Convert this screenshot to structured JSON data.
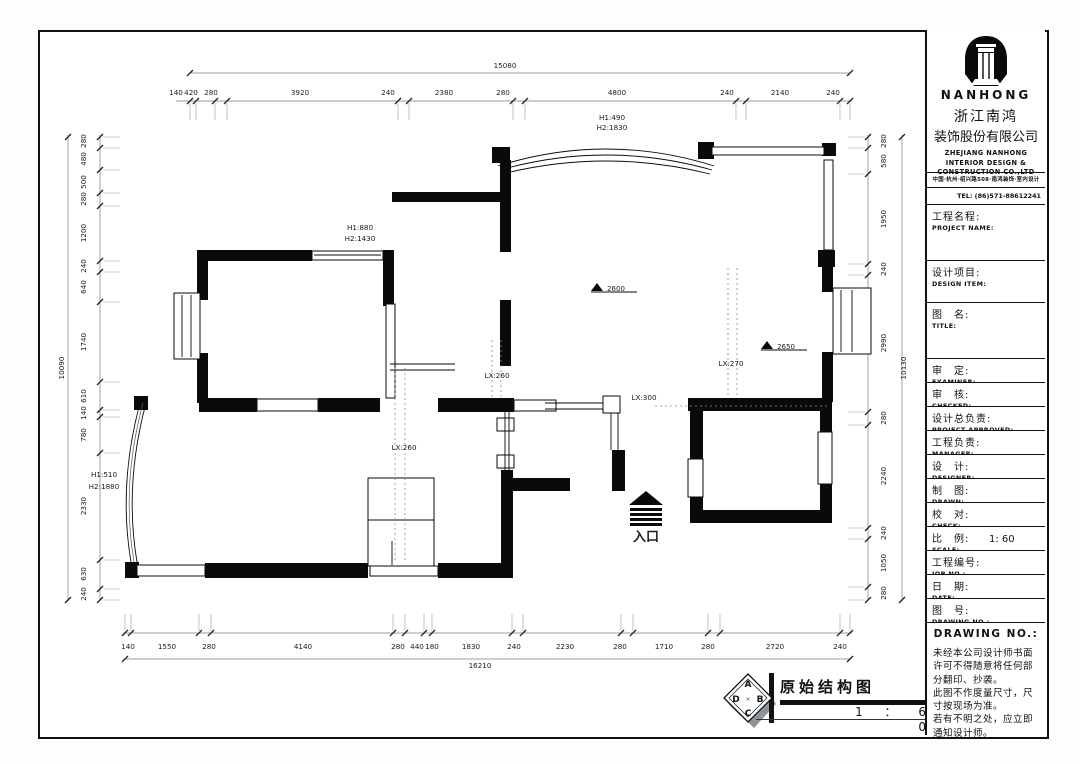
{
  "title_block": {
    "brand": "NANHONG",
    "company_cn_1": "浙江南鸿",
    "company_cn_2": "装饰股份有限公司",
    "company_en": "ZHEJIANG NANHONG\nINTERIOR DESIGN &\nCONSTRUCTION CO.,LTD",
    "address": "中国·杭州·绍兴路508·南鸿装饰·室内设计",
    "tel": "TEL: (86)571-88612241 88612242",
    "fields": [
      {
        "cn": "工程名程:",
        "en": "PROJECT NAME:",
        "value": ""
      },
      {
        "cn": "设计项目:",
        "en": "DESIGN ITEM:",
        "value": ""
      },
      {
        "cn": "图　名:",
        "en": "TITLE:",
        "value": ""
      },
      {
        "cn": "审　定:",
        "en": "EXAMINER:",
        "value": ""
      },
      {
        "cn": "审　核:",
        "en": "CHECKED:",
        "value": ""
      },
      {
        "cn": "设计总负责:",
        "en": "PROJECT APPROVED:",
        "value": ""
      },
      {
        "cn": "工程负责:",
        "en": "MANAGER:",
        "value": ""
      },
      {
        "cn": "设　计:",
        "en": "DESIGNER:",
        "value": ""
      },
      {
        "cn": "制　图:",
        "en": "DRAWN:",
        "value": ""
      },
      {
        "cn": "校　对:",
        "en": "CHECK:",
        "value": ""
      },
      {
        "cn": "比　例:",
        "en": "SCALE:",
        "value": "1: 60"
      },
      {
        "cn": "工程编号:",
        "en": "JOB NO.:",
        "value": ""
      },
      {
        "cn": "日　期:",
        "en": "DATE:",
        "value": ""
      },
      {
        "cn": "图　号:",
        "en": "DRAWING NO.:",
        "value": ""
      }
    ],
    "drawing_no_header": "DRAWING NO.:",
    "notes": "未经本公司设计师书面\n许可不得随意将任何部\n分翻印、抄袭。\n此图不作度量尺寸，尺\n寸按现场为准。\n若有不明之处，应立即\n通知设计师。"
  },
  "footer": {
    "drawing_title": "原始结构图",
    "scale_text": "1 ： 6 0",
    "compass_letters": {
      "a": "A",
      "b": "B",
      "c": "C",
      "d": "D"
    }
  },
  "plan": {
    "labels": [
      {
        "t": "15080",
        "x": 505,
        "y": 68
      },
      {
        "t": "140",
        "x": 176,
        "y": 95
      },
      {
        "t": "420",
        "x": 191,
        "y": 95
      },
      {
        "t": "280",
        "x": 211,
        "y": 95
      },
      {
        "t": "3920",
        "x": 300,
        "y": 95
      },
      {
        "t": "240",
        "x": 388,
        "y": 95
      },
      {
        "t": "2380",
        "x": 444,
        "y": 95
      },
      {
        "t": "280",
        "x": 503,
        "y": 95
      },
      {
        "t": "4800",
        "x": 617,
        "y": 95
      },
      {
        "t": "240",
        "x": 727,
        "y": 95
      },
      {
        "t": "2140",
        "x": 780,
        "y": 95
      },
      {
        "t": "240",
        "x": 833,
        "y": 95
      },
      {
        "t": "16210",
        "x": 480,
        "y": 668
      },
      {
        "t": "140",
        "x": 128,
        "y": 649
      },
      {
        "t": "1550",
        "x": 167,
        "y": 649
      },
      {
        "t": "280",
        "x": 209,
        "y": 649
      },
      {
        "t": "4140",
        "x": 303,
        "y": 649
      },
      {
        "t": "280",
        "x": 398,
        "y": 649
      },
      {
        "t": "440",
        "x": 417,
        "y": 649
      },
      {
        "t": "180",
        "x": 432,
        "y": 649
      },
      {
        "t": "1830",
        "x": 471,
        "y": 649
      },
      {
        "t": "240",
        "x": 514,
        "y": 649
      },
      {
        "t": "2230",
        "x": 565,
        "y": 649
      },
      {
        "t": "280",
        "x": 620,
        "y": 649
      },
      {
        "t": "1710",
        "x": 664,
        "y": 649
      },
      {
        "t": "280",
        "x": 708,
        "y": 649
      },
      {
        "t": "2720",
        "x": 775,
        "y": 649
      },
      {
        "t": "240",
        "x": 840,
        "y": 649
      },
      {
        "t": "10090",
        "x": 64,
        "y": 368,
        "r": -90
      },
      {
        "t": "280",
        "x": 86,
        "y": 141,
        "r": -90
      },
      {
        "t": "480",
        "x": 86,
        "y": 159,
        "r": -90
      },
      {
        "t": "500",
        "x": 86,
        "y": 182,
        "r": -90
      },
      {
        "t": "280",
        "x": 86,
        "y": 199,
        "r": -90
      },
      {
        "t": "1200",
        "x": 86,
        "y": 233,
        "r": -90
      },
      {
        "t": "240",
        "x": 86,
        "y": 266,
        "r": -90
      },
      {
        "t": "640",
        "x": 86,
        "y": 287,
        "r": -90
      },
      {
        "t": "1740",
        "x": 86,
        "y": 342,
        "r": -90
      },
      {
        "t": "610",
        "x": 86,
        "y": 396,
        "r": -90
      },
      {
        "t": "140",
        "x": 86,
        "y": 413,
        "r": -90
      },
      {
        "t": "780",
        "x": 86,
        "y": 435,
        "r": -90
      },
      {
        "t": "2330",
        "x": 86,
        "y": 506,
        "r": -90
      },
      {
        "t": "630",
        "x": 86,
        "y": 574,
        "r": -90
      },
      {
        "t": "240",
        "x": 86,
        "y": 594,
        "r": -90
      },
      {
        "t": "10130",
        "x": 906,
        "y": 368,
        "r": -90
      },
      {
        "t": "280",
        "x": 886,
        "y": 141,
        "r": -90
      },
      {
        "t": "580",
        "x": 886,
        "y": 161,
        "r": -90
      },
      {
        "t": "1950",
        "x": 886,
        "y": 219,
        "r": -90
      },
      {
        "t": "240",
        "x": 886,
        "y": 269,
        "r": -90
      },
      {
        "t": "2990",
        "x": 886,
        "y": 343,
        "r": -90
      },
      {
        "t": "280",
        "x": 886,
        "y": 418,
        "r": -90
      },
      {
        "t": "2240",
        "x": 886,
        "y": 476,
        "r": -90
      },
      {
        "t": "240",
        "x": 886,
        "y": 533,
        "r": -90
      },
      {
        "t": "1050",
        "x": 886,
        "y": 563,
        "r": -90
      },
      {
        "t": "280",
        "x": 886,
        "y": 593,
        "r": -90
      },
      {
        "t": "H1:490",
        "x": 612,
        "y": 120
      },
      {
        "t": "H2:1830",
        "x": 612,
        "y": 130
      },
      {
        "t": "H1:880",
        "x": 360,
        "y": 230
      },
      {
        "t": "H2:1430",
        "x": 360,
        "y": 241
      },
      {
        "t": "H1:510",
        "x": 104,
        "y": 477
      },
      {
        "t": "H2:1880",
        "x": 104,
        "y": 489
      },
      {
        "t": "LX:260",
        "x": 497,
        "y": 378
      },
      {
        "t": "LX:300",
        "x": 644,
        "y": 400
      },
      {
        "t": "LX:270",
        "x": 731,
        "y": 366
      },
      {
        "t": "LX:260",
        "x": 404,
        "y": 450
      },
      {
        "t": "2600",
        "x": 616,
        "y": 291,
        "s": 7
      },
      {
        "t": "2650",
        "x": 786,
        "y": 349,
        "s": 7
      },
      {
        "t": "入口",
        "x": 646,
        "y": 541,
        "s": 13,
        "b": true
      }
    ]
  }
}
